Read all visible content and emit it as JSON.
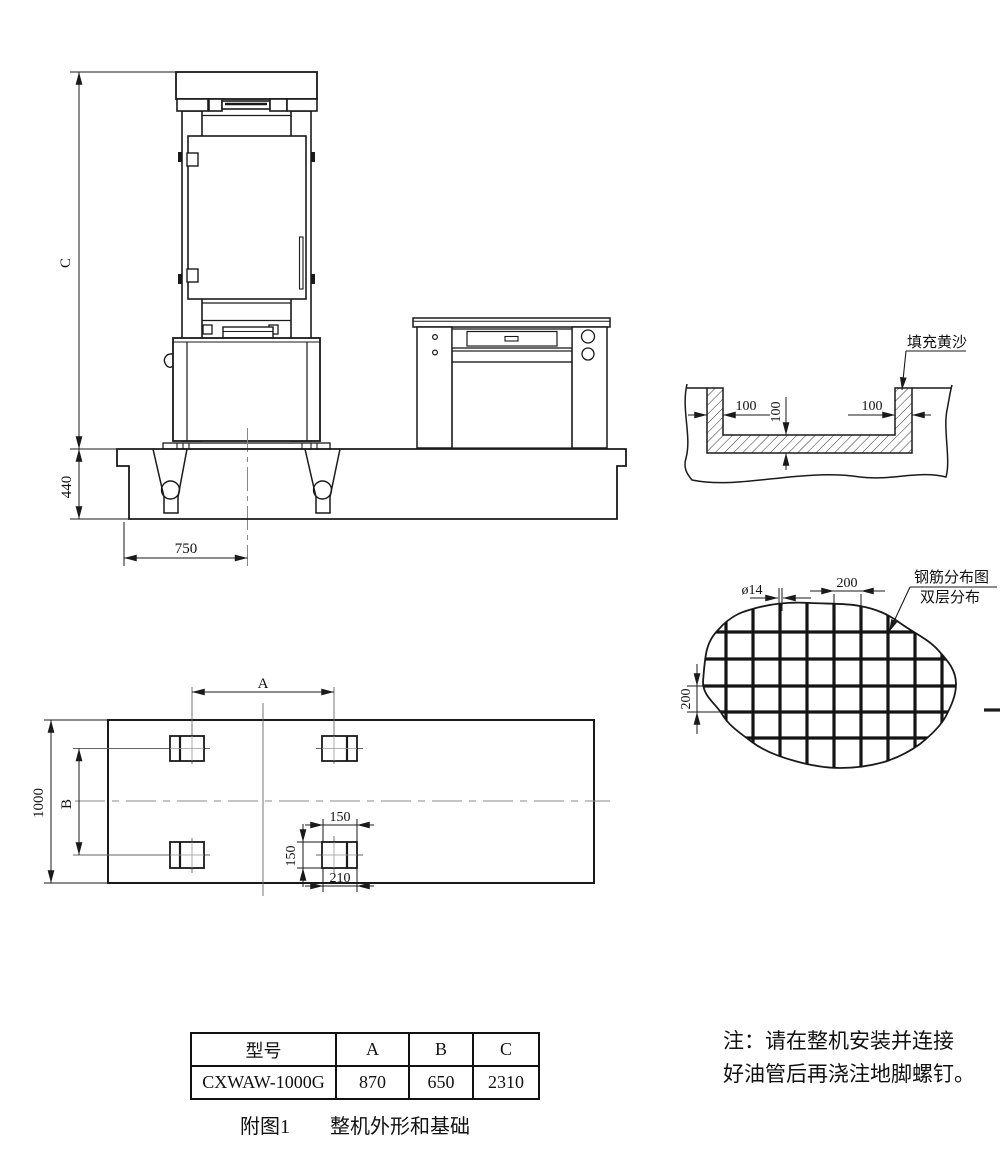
{
  "colors": {
    "line": "#1a1a1a",
    "centerline": "#888888",
    "background": "#ffffff"
  },
  "front_view": {
    "dim_c": "C",
    "dim_440": "440",
    "dim_750": "750"
  },
  "sand_detail": {
    "label": "填充黄沙",
    "dim_wall_left": "100",
    "dim_floor": "100",
    "dim_wall_right": "100"
  },
  "rebar_detail": {
    "label_line1": "钢筋分布图",
    "label_line2": "双层分布",
    "dim_bar_dia": "ø14",
    "dim_spacing_h": "200",
    "dim_spacing_v": "200"
  },
  "plan_view": {
    "dim_a": "A",
    "dim_b": "B",
    "dim_1000": "1000",
    "dim_150_w": "150",
    "dim_150_h": "150",
    "dim_210": "210"
  },
  "spec_table": {
    "headers": [
      "型号",
      "A",
      "B",
      "C"
    ],
    "row": [
      "CXWAW-1000G",
      "870",
      "650",
      "2310"
    ]
  },
  "caption": {
    "figure_no": "附图1",
    "title": "整机外形和基础"
  },
  "note": {
    "line1": "注：请在整机安装并连接",
    "line2": "好油管后再浇注地脚螺钉。"
  }
}
